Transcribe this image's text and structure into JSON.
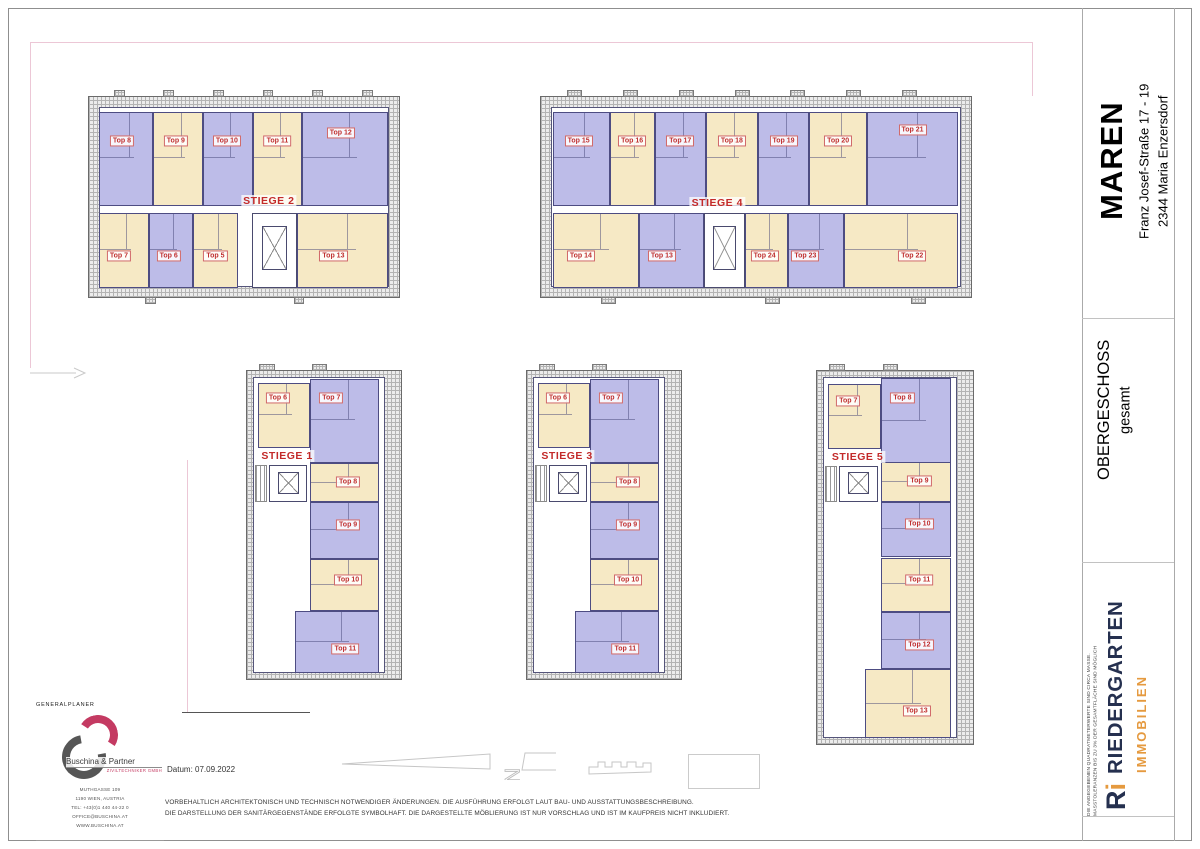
{
  "title_block": {
    "project": "MAREN",
    "address_line1": "Franz Josef-Straße 17 - 19",
    "address_line2": "2344  Maria Enzersdorf",
    "floor_title": "OBERGESCHOSS",
    "floor_subtitle": "gesamt",
    "size_note_line1": "DIE ANGEGEBENEN QUADRATMETERWERTE SIND CIRCA MASSE.",
    "size_note_line2": "MASSTOLERANZEN BIS ZU 3% DER GESAMTFLÄCHE SIND MÖGLICH",
    "brand": {
      "mark": "R",
      "mark_i": "i",
      "name": "RIEDERGARTEN",
      "sub": "IMMOBILIEN",
      "navy": "#25304f",
      "orange": "#e59a3f"
    }
  },
  "planner_block": {
    "heading": "GENERALPLANER",
    "company": "Buschina & Partner",
    "company_sub": "ZIVILTECHNIKER GMBH",
    "address_line1": "MUTHGASSE 109",
    "address_line2": "1190 WIEN, AUSTRIA",
    "address_line3": "TEL: +43(0)1 440 44-22 0",
    "address_line4": "OFFICE@BUSCHINA.AT",
    "address_line5": "WWW.BUSCHINA.AT"
  },
  "footer": {
    "date": "Datum: 07.09.2022",
    "disclaimer_line1": "VORBEHALTLICH ARCHITEKTONISCH UND TECHNISCH NOTWENDIGER ÄNDERUNGEN. DIE AUSFÜHRUNG ERFOLGT LAUT BAU- UND AUSSTATTUNGSBESCHREIBUNG.",
    "disclaimer_line2": "DIE DARSTELLUNG DER SANITÄRGEGENSTÄNDE ERFOLGTE SYMBOLHAFT. DIE DARGESTELLTE MÖBLIERUNG IST NUR VORSCHLAG UND IST IM KAUFPREIS NICHT INKLUDIERT."
  },
  "plan": {
    "colors": {
      "purple": "#bdbce8",
      "cream": "#f6e9c5",
      "wall": "#4d4c82",
      "label_red": "#c03030"
    },
    "buildings": [
      {
        "id": "stiege-2",
        "name": "STIEGE 2",
        "type": "h",
        "rect": {
          "x": 88,
          "y": 96,
          "w": 312,
          "h": 202
        },
        "label": {
          "x": 58,
          "y": 52
        },
        "stubs_top": [
          8,
          24,
          40,
          56,
          72,
          88
        ],
        "stubs_bottom": [
          18,
          66
        ],
        "core": {
          "l": 52.5,
          "t": 58,
          "w": 14.5,
          "h": 37.5
        },
        "units": [
          {
            "label": "Top 8",
            "color": "purple",
            "l": 3.2,
            "t": 7.5,
            "w": 17.6,
            "h": 47,
            "tx": 42,
            "ty": 30
          },
          {
            "label": "Top 9",
            "color": "cream",
            "l": 20.8,
            "t": 7.5,
            "w": 16,
            "h": 47,
            "tx": 45,
            "ty": 30
          },
          {
            "label": "Top 10",
            "color": "purple",
            "l": 36.8,
            "t": 7.5,
            "w": 16,
            "h": 47,
            "tx": 48,
            "ty": 30
          },
          {
            "label": "Top 11",
            "color": "cream",
            "l": 52.8,
            "t": 7.5,
            "w": 16,
            "h": 47,
            "tx": 50,
            "ty": 30
          },
          {
            "label": "Top 12",
            "color": "purple",
            "l": 68.8,
            "t": 7.5,
            "w": 27.5,
            "h": 47,
            "tx": 45,
            "ty": 22
          },
          {
            "label": "Top 7",
            "color": "cream",
            "l": 3.2,
            "t": 58,
            "w": 16,
            "h": 37.5,
            "tx": 40,
            "ty": 58
          },
          {
            "label": "Top 6",
            "color": "purple",
            "l": 19.2,
            "t": 58,
            "w": 14.4,
            "h": 37.5,
            "tx": 45,
            "ty": 58
          },
          {
            "label": "Top 5",
            "color": "cream",
            "l": 33.6,
            "t": 58,
            "w": 14.4,
            "h": 37.5,
            "tx": 50,
            "ty": 58
          },
          {
            "label": "Top 13",
            "color": "cream",
            "l": 67,
            "t": 58,
            "w": 29.5,
            "h": 37.5,
            "tx": 40,
            "ty": 58
          }
        ]
      },
      {
        "id": "stiege-4",
        "name": "STIEGE 4",
        "type": "h",
        "rect": {
          "x": 540,
          "y": 96,
          "w": 432,
          "h": 202
        },
        "label": {
          "x": 41,
          "y": 53
        },
        "stubs_top": [
          6,
          19,
          32,
          45,
          58,
          71,
          84
        ],
        "stubs_bottom": [
          14,
          52,
          86
        ],
        "core": {
          "l": 37.8,
          "t": 58,
          "w": 9.7,
          "h": 37.5
        },
        "units": [
          {
            "label": "Top 15",
            "color": "purple",
            "l": 2.8,
            "t": 7.5,
            "w": 13.2,
            "h": 47,
            "tx": 45,
            "ty": 30
          },
          {
            "label": "Top 16",
            "color": "cream",
            "l": 16,
            "t": 7.5,
            "w": 10.4,
            "h": 47,
            "tx": 50,
            "ty": 30
          },
          {
            "label": "Top 17",
            "color": "purple",
            "l": 26.4,
            "t": 7.5,
            "w": 12,
            "h": 47,
            "tx": 50,
            "ty": 30
          },
          {
            "label": "Top 18",
            "color": "cream",
            "l": 38.4,
            "t": 7.5,
            "w": 12,
            "h": 47,
            "tx": 50,
            "ty": 30
          },
          {
            "label": "Top 19",
            "color": "purple",
            "l": 50.4,
            "t": 7.5,
            "w": 12,
            "h": 47,
            "tx": 50,
            "ty": 30
          },
          {
            "label": "Top 20",
            "color": "cream",
            "l": 62.4,
            "t": 7.5,
            "w": 13.4,
            "h": 47,
            "tx": 50,
            "ty": 30
          },
          {
            "label": "Top 21",
            "color": "purple",
            "l": 75.8,
            "t": 7.5,
            "w": 21.2,
            "h": 47,
            "tx": 50,
            "ty": 18
          },
          {
            "label": "Top 14",
            "color": "cream",
            "l": 2.8,
            "t": 58,
            "w": 20,
            "h": 37.5,
            "tx": 32,
            "ty": 58
          },
          {
            "label": "Top 13",
            "color": "purple",
            "l": 22.8,
            "t": 58,
            "w": 15,
            "h": 37.5,
            "tx": 35,
            "ty": 58
          },
          {
            "label": "Top 24",
            "color": "cream",
            "l": 47.5,
            "t": 58,
            "w": 10,
            "h": 37.5,
            "tx": 45,
            "ty": 58
          },
          {
            "label": "Top 23",
            "color": "purple",
            "l": 57.5,
            "t": 58,
            "w": 13,
            "h": 37.5,
            "tx": 30,
            "ty": 58
          },
          {
            "label": "Top 22",
            "color": "cream",
            "l": 70.5,
            "t": 58,
            "w": 26.5,
            "h": 37.5,
            "tx": 60,
            "ty": 58
          }
        ]
      },
      {
        "id": "stiege-1",
        "name": "STIEGE 1",
        "type": "v",
        "rect": {
          "x": 246,
          "y": 370,
          "w": 156,
          "h": 310
        },
        "label": {
          "x": 26,
          "y": 27.5
        },
        "stubs_top": [
          8,
          42
        ],
        "stubs_bottom": [],
        "core": {
          "l": 14,
          "t": 30.5,
          "w": 25,
          "h": 12
        },
        "stairs": {
          "l": 5,
          "t": 30.5,
          "w": 8,
          "h": 12
        },
        "units": [
          {
            "label": "Top 6",
            "color": "cream",
            "l": 7,
            "t": 4,
            "w": 34,
            "h": 21,
            "tx": 38,
            "ty": 22
          },
          {
            "label": "Top 7",
            "color": "purple",
            "l": 41,
            "t": 2.5,
            "w": 45,
            "h": 27.5,
            "tx": 30,
            "ty": 22
          },
          {
            "label": "Top 8",
            "color": "cream",
            "l": 41,
            "t": 30,
            "w": 45,
            "h": 12.5,
            "tx": 55,
            "ty": 48
          },
          {
            "label": "Top 9",
            "color": "purple",
            "l": 41,
            "t": 42.5,
            "w": 45,
            "h": 18.5,
            "tx": 55,
            "ty": 40
          },
          {
            "label": "Top 10",
            "color": "cream",
            "l": 41,
            "t": 61,
            "w": 45,
            "h": 17,
            "tx": 55,
            "ty": 40
          },
          {
            "label": "Top 11",
            "color": "purple",
            "l": 31,
            "t": 78,
            "w": 55,
            "h": 20,
            "tx": 60,
            "ty": 62
          }
        ]
      },
      {
        "id": "stiege-3",
        "name": "STIEGE 3",
        "type": "v",
        "rect": {
          "x": 526,
          "y": 370,
          "w": 156,
          "h": 310
        },
        "label": {
          "x": 26,
          "y": 27.5
        },
        "stubs_top": [
          8,
          42
        ],
        "stubs_bottom": [],
        "core": {
          "l": 14,
          "t": 30.5,
          "w": 25,
          "h": 12
        },
        "stairs": {
          "l": 5,
          "t": 30.5,
          "w": 8,
          "h": 12
        },
        "units": [
          {
            "label": "Top 6",
            "color": "cream",
            "l": 7,
            "t": 4,
            "w": 34,
            "h": 21,
            "tx": 38,
            "ty": 22
          },
          {
            "label": "Top 7",
            "color": "purple",
            "l": 41,
            "t": 2.5,
            "w": 45,
            "h": 27.5,
            "tx": 30,
            "ty": 22
          },
          {
            "label": "Top 8",
            "color": "cream",
            "l": 41,
            "t": 30,
            "w": 45,
            "h": 12.5,
            "tx": 55,
            "ty": 48
          },
          {
            "label": "Top 9",
            "color": "purple",
            "l": 41,
            "t": 42.5,
            "w": 45,
            "h": 18.5,
            "tx": 55,
            "ty": 40
          },
          {
            "label": "Top 10",
            "color": "cream",
            "l": 41,
            "t": 61,
            "w": 45,
            "h": 17,
            "tx": 55,
            "ty": 40
          },
          {
            "label": "Top 11",
            "color": "purple",
            "l": 31,
            "t": 78,
            "w": 55,
            "h": 20,
            "tx": 60,
            "ty": 62
          }
        ]
      },
      {
        "id": "stiege-5",
        "name": "STIEGE 5",
        "type": "v",
        "rect": {
          "x": 816,
          "y": 370,
          "w": 158,
          "h": 375
        },
        "label": {
          "x": 26,
          "y": 23
        },
        "stubs_top": [
          8,
          42
        ],
        "stubs_bottom": [],
        "core": {
          "l": 14,
          "t": 25.5,
          "w": 25,
          "h": 9.5
        },
        "stairs": {
          "l": 5,
          "t": 25.5,
          "w": 8,
          "h": 9.5
        },
        "units": [
          {
            "label": "Top 7",
            "color": "cream",
            "l": 7,
            "t": 3.5,
            "w": 34,
            "h": 17.5,
            "tx": 38,
            "ty": 25
          },
          {
            "label": "Top 8",
            "color": "purple",
            "l": 41,
            "t": 2,
            "w": 45,
            "h": 23,
            "tx": 30,
            "ty": 22
          },
          {
            "label": "Top 9",
            "color": "cream",
            "l": 41,
            "t": 24.5,
            "w": 45,
            "h": 10.5,
            "tx": 55,
            "ty": 48
          },
          {
            "label": "Top 10",
            "color": "purple",
            "l": 41,
            "t": 35,
            "w": 45,
            "h": 15,
            "tx": 55,
            "ty": 40
          },
          {
            "label": "Top 11",
            "color": "cream",
            "l": 41,
            "t": 50,
            "w": 45,
            "h": 14.5,
            "tx": 55,
            "ty": 42
          },
          {
            "label": "Top 12",
            "color": "purple",
            "l": 41,
            "t": 64.5,
            "w": 45,
            "h": 15.5,
            "tx": 55,
            "ty": 58
          },
          {
            "label": "Top 13",
            "color": "cream",
            "l": 31,
            "t": 80,
            "w": 55,
            "h": 18.5,
            "tx": 60,
            "ty": 60
          }
        ]
      }
    ]
  }
}
